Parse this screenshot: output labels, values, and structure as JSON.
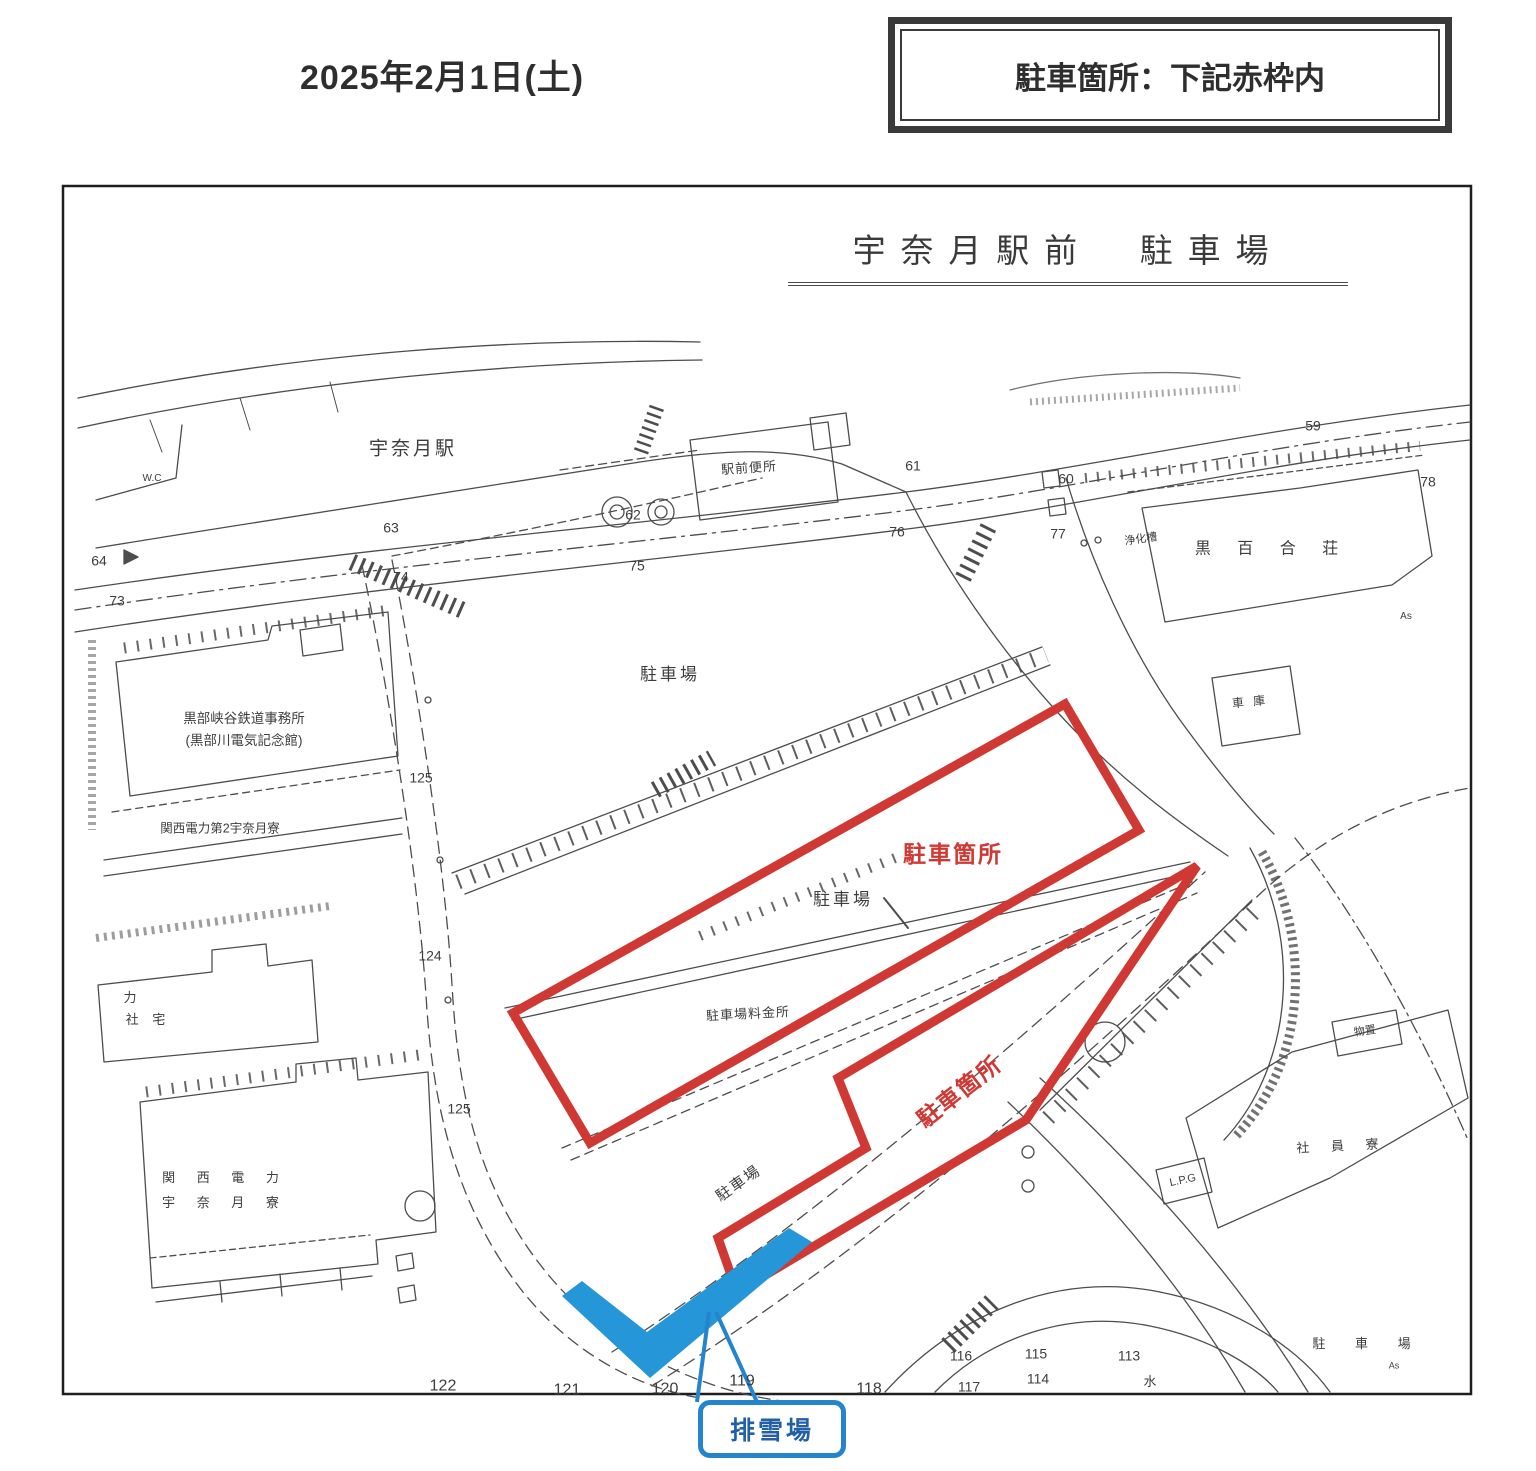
{
  "colors": {
    "red": "#d03833",
    "blue_fill": "#2596d8",
    "blue_border": "#2484cd",
    "blue_text": "#215fa6",
    "ink": "#3d3d3d"
  },
  "header": {
    "date": "2025年2月1日(土)",
    "notice": "駐車箇所：下記赤枠内"
  },
  "map": {
    "title": "宇奈月駅前　駐車場",
    "snow_label": "排雪場",
    "labels": [
      {
        "t": "宇奈月駅",
        "x": 413,
        "y": 450,
        "fs": 19,
        "ls": 3
      },
      {
        "t": "W.C",
        "x": 152,
        "y": 479,
        "fs": 10
      },
      {
        "t": "駅前便所",
        "x": 749,
        "y": 468,
        "fs": 13,
        "ls": 1,
        "rot": -4
      },
      {
        "t": "駐車場",
        "x": 670,
        "y": 675,
        "fs": 17,
        "ls": 3
      },
      {
        "t": "駐車場",
        "x": 843,
        "y": 900,
        "fs": 17,
        "ls": 3
      },
      {
        "t": "駐車場料金所",
        "x": 748,
        "y": 1014,
        "fs": 13,
        "ls": 1,
        "rot": -3
      },
      {
        "t": "駐車場",
        "x": 739,
        "y": 1184,
        "fs": 15,
        "ls": 2,
        "rot": -35
      },
      {
        "t": "黒部峡谷鉄道事務所",
        "x": 244,
        "y": 719,
        "fs": 13.5
      },
      {
        "t": "(黒部川電気記念館)",
        "x": 244,
        "y": 741,
        "fs": 13.5
      },
      {
        "t": "関西電力第2宇奈月寮",
        "x": 220,
        "y": 829,
        "fs": 12.5
      },
      {
        "t": "力",
        "x": 130,
        "y": 998,
        "fs": 13
      },
      {
        "t": "社 宅",
        "x": 148,
        "y": 1020,
        "fs": 13,
        "ls": 5
      },
      {
        "t": "関 西 電 力",
        "x": 225,
        "y": 1178,
        "fs": 13,
        "ls": 9
      },
      {
        "t": "宇 奈 月 寮",
        "x": 225,
        "y": 1203,
        "fs": 13,
        "ls": 9
      },
      {
        "t": "黒 百 合 荘",
        "x": 1272,
        "y": 549,
        "fs": 16,
        "ls": 11
      },
      {
        "t": "浄化槽",
        "x": 1141,
        "y": 540,
        "fs": 11,
        "rot": -8
      },
      {
        "t": "車 庫",
        "x": 1250,
        "y": 702,
        "fs": 12,
        "ls": 3,
        "rot": -6
      },
      {
        "t": "As",
        "x": 1406,
        "y": 617,
        "fs": 10
      },
      {
        "t": "物置",
        "x": 1365,
        "y": 1032,
        "fs": 11,
        "rot": -8
      },
      {
        "t": "社 員 寮",
        "x": 1342,
        "y": 1146,
        "fs": 13,
        "ls": 9,
        "rot": -3
      },
      {
        "t": "L.P.G",
        "x": 1183,
        "y": 1181,
        "fs": 11,
        "rot": -12
      },
      {
        "t": "水",
        "x": 1150,
        "y": 1382,
        "fs": 13
      },
      {
        "t": "駐 車 場",
        "x": 1368,
        "y": 1344,
        "fs": 13,
        "ls": 13
      },
      {
        "t": "As",
        "x": 1394,
        "y": 1366,
        "fs": 9
      },
      {
        "t": "駐車箇所",
        "x": 953,
        "y": 855,
        "fs": 23,
        "ls": 2,
        "c": "red",
        "b": 1
      },
      {
        "t": "駐車箇所",
        "x": 960,
        "y": 1092,
        "fs": 23,
        "ls": 2,
        "c": "red",
        "b": 1,
        "rot": -38
      }
    ],
    "markers": [
      {
        "t": "64",
        "x": 99,
        "y": 561
      },
      {
        "t": "73",
        "x": 117,
        "y": 601
      },
      {
        "t": "63",
        "x": 391,
        "y": 528
      },
      {
        "t": "74",
        "x": 401,
        "y": 577
      },
      {
        "t": "62",
        "x": 633,
        "y": 515
      },
      {
        "t": "75",
        "x": 637,
        "y": 566
      },
      {
        "t": "61",
        "x": 913,
        "y": 466
      },
      {
        "t": "76",
        "x": 897,
        "y": 532
      },
      {
        "t": "60",
        "x": 1066,
        "y": 479
      },
      {
        "t": "77",
        "x": 1058,
        "y": 534
      },
      {
        "t": "59",
        "x": 1313,
        "y": 426
      },
      {
        "t": "78",
        "x": 1428,
        "y": 482
      },
      {
        "t": "125",
        "x": 421,
        "y": 778
      },
      {
        "t": "124",
        "x": 430,
        "y": 956
      },
      {
        "t": "125",
        "x": 459,
        "y": 1109
      },
      {
        "t": "122",
        "x": 443,
        "y": 1386,
        "fs": 16
      },
      {
        "t": "121",
        "x": 567,
        "y": 1390,
        "fs": 16
      },
      {
        "t": "120",
        "x": 665,
        "y": 1389,
        "fs": 16
      },
      {
        "t": "119",
        "x": 742,
        "y": 1381,
        "fs": 16
      },
      {
        "t": "118",
        "x": 869,
        "y": 1389,
        "fs": 16
      },
      {
        "t": "116",
        "x": 961,
        "y": 1356
      },
      {
        "t": "115",
        "x": 1036,
        "y": 1354
      },
      {
        "t": "114",
        "x": 1038,
        "y": 1379
      },
      {
        "t": "117",
        "x": 969,
        "y": 1387
      },
      {
        "t": "113",
        "x": 1129,
        "y": 1356
      }
    ]
  }
}
